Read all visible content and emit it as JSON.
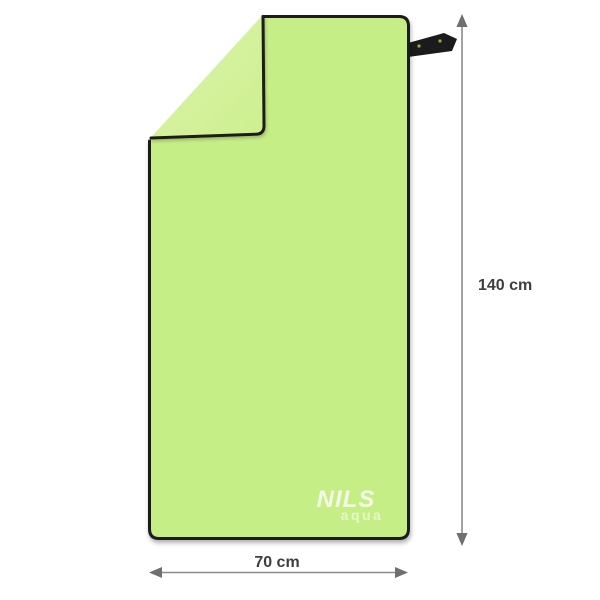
{
  "product": {
    "brand": "NILS",
    "sub_brand": "aqua",
    "item": "microfiber beach towel, folded corner at top-left, black hem, hang loop at top-right"
  },
  "dimensions": {
    "height_label": "140 cm",
    "width_label": "70 cm"
  },
  "icons": {
    "height_arrow": "double-headed-vertical-dimension-arrow",
    "width_arrow": "double-headed-horizontal-dimension-arrow",
    "hang_loop": "black-fabric-hang-loop"
  },
  "colors": {
    "background": "#ffffff",
    "towel_front": "#c6ee86",
    "towel_back_fold": "#ccef8e",
    "towel_back_fold_light": "#ddf4ac",
    "hem": "#1b1b1e",
    "strap_logo_green": "#93b13a",
    "arrow": "#8c8c8e",
    "arrow_head": "#6f6f71",
    "label_text": "#3e3e40",
    "logo_white": "#ffffff"
  }
}
